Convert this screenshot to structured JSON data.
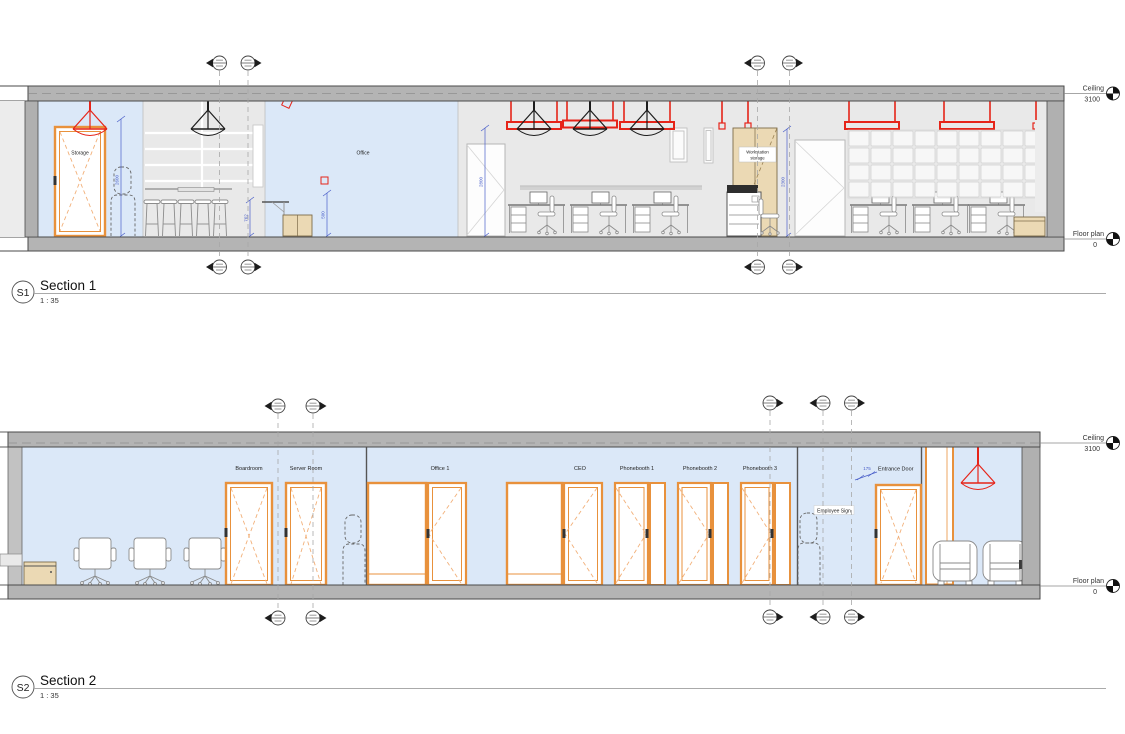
{
  "colors": {
    "interior_blue": "#dbe8f8",
    "wall_gray": "#b4b4b4",
    "beyond_gray": "#ececec",
    "zone_gray": "#e9e9e9",
    "door_orange": "#e8913c",
    "accent_red": "#e62419",
    "cabinet_tan": "#ebd9b4",
    "dimension_blue": "#4a5fc9",
    "pendant_black": "#1c1c1c"
  },
  "levels": {
    "ceiling": {
      "name": "Ceiling",
      "elevation": "3100"
    },
    "floor": {
      "name": "Floor plan",
      "elevation": "0"
    }
  },
  "section1": {
    "tag": "S1",
    "title": "Section 1",
    "scale": "1 : 35",
    "room_labels": {
      "storage": "Storage",
      "office": "Office",
      "workstation_storage_line1": "Workstation",
      "workstation_storage_line2": "storage"
    },
    "dimensions": {
      "storage_clearance": "2600",
      "counter": "762",
      "cabinet": "500",
      "door_opening": "2800",
      "storage_unit": "2300"
    }
  },
  "section2": {
    "tag": "S2",
    "title": "Section 2",
    "scale": "1 : 35",
    "door_labels": [
      "Boardroom",
      "Server Room",
      "Office 1",
      "CEO",
      "Phonebooth 1",
      "Phonebooth 2",
      "Phonebooth 3"
    ],
    "entrance": {
      "dimension": "175",
      "label": "Entrance Door"
    },
    "employee_sign_label": "Employee Sign"
  }
}
